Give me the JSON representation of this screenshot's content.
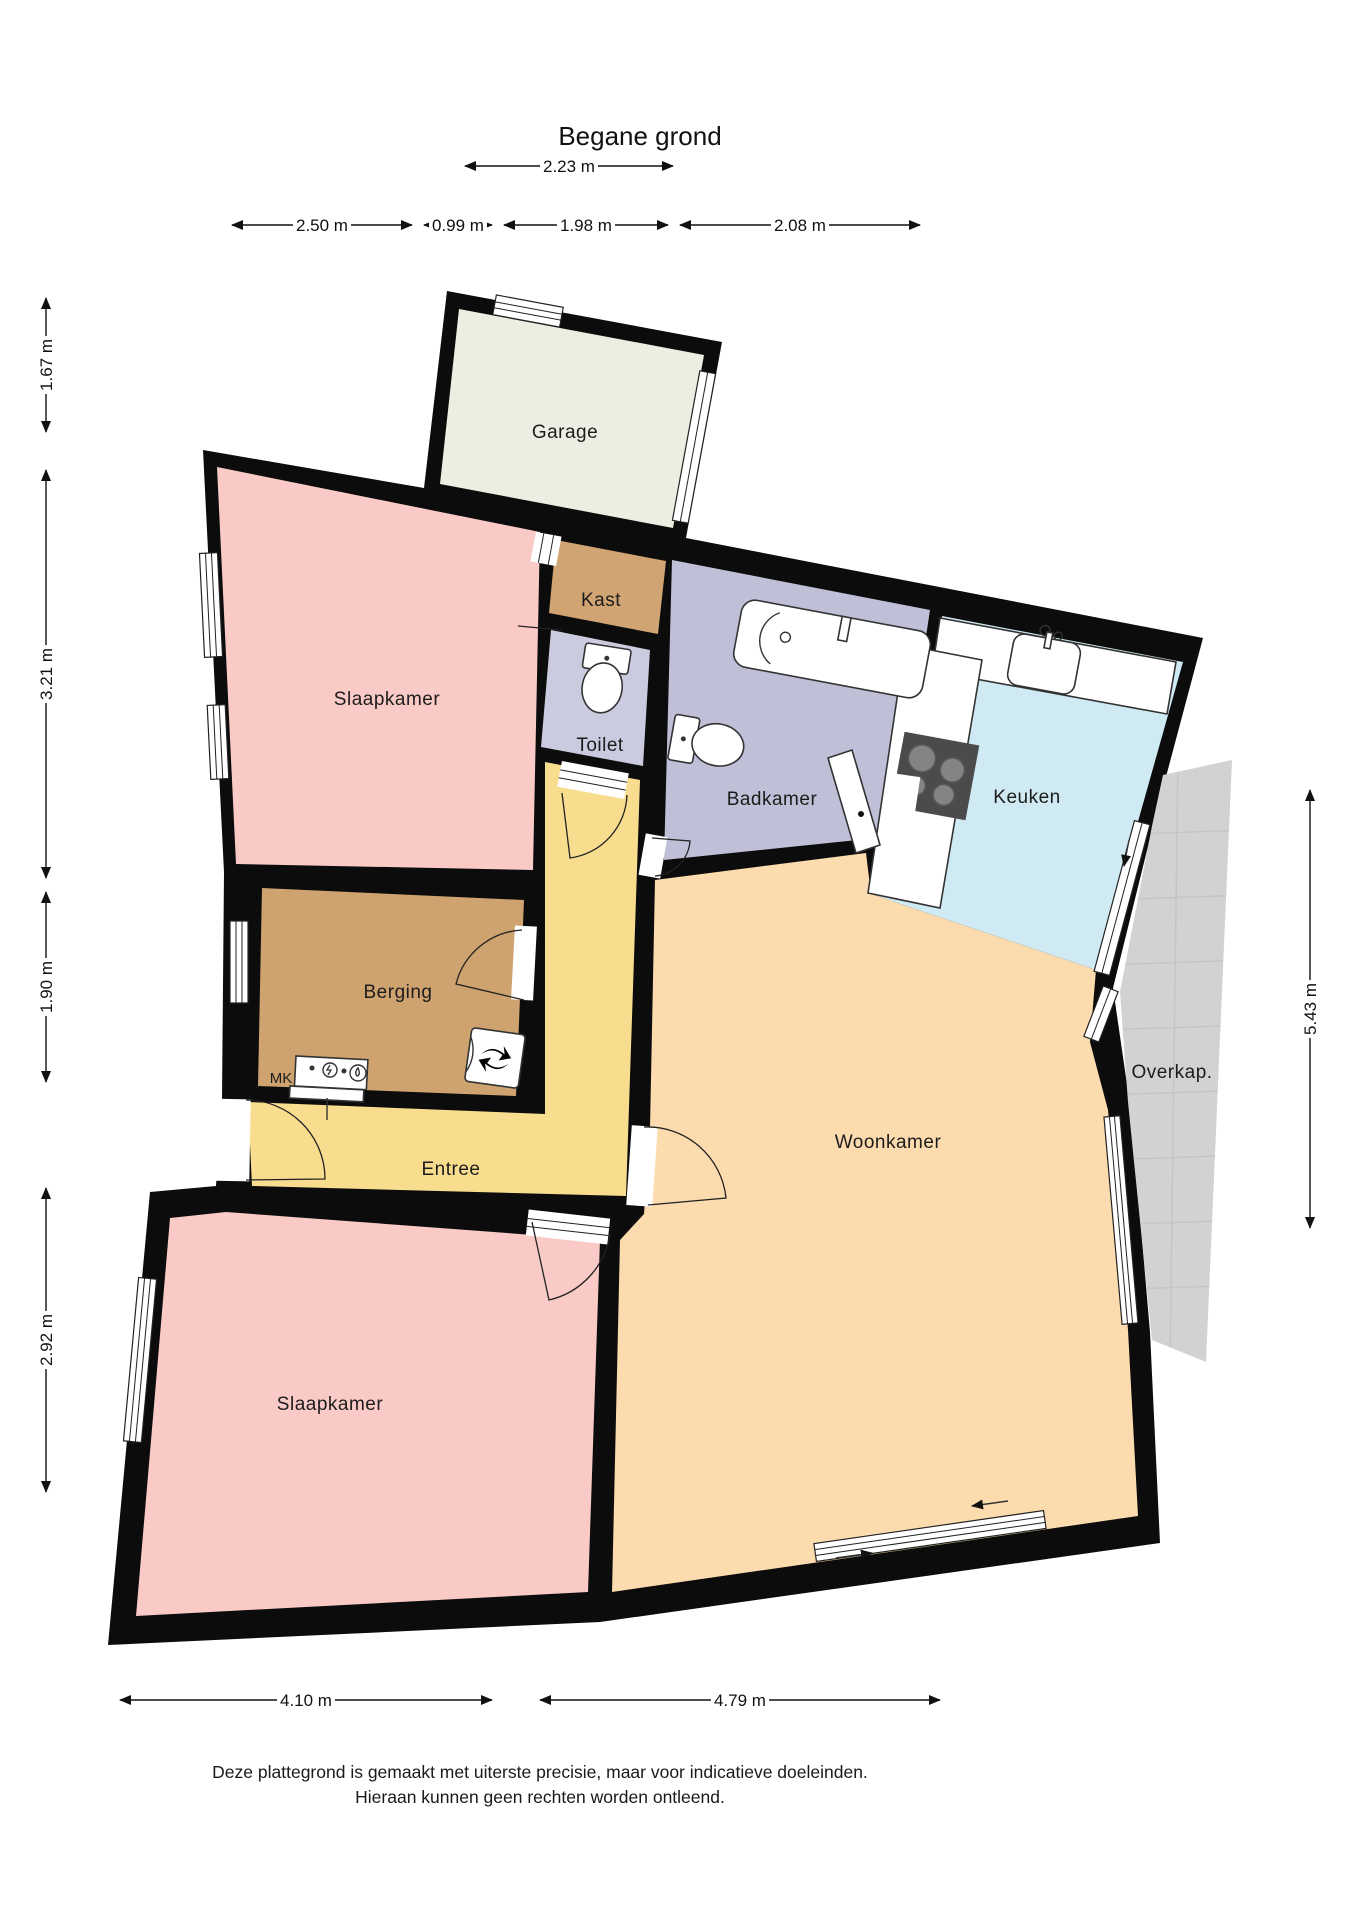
{
  "title": "Begane grond",
  "rooms": {
    "garage": {
      "label": "Garage"
    },
    "kast": {
      "label": "Kast"
    },
    "slaapkamer_boven": {
      "label": "Slaapkamer"
    },
    "toilet": {
      "label": "Toilet"
    },
    "badkamer": {
      "label": "Badkamer"
    },
    "keuken": {
      "label": "Keuken"
    },
    "berging": {
      "label": "Berging"
    },
    "meterkast": {
      "label": "MK"
    },
    "entree": {
      "label": "Entree"
    },
    "woonkamer": {
      "label": "Woonkamer"
    },
    "overkapping": {
      "label": "Overkap."
    },
    "slaapkamer_onder": {
      "label": "Slaapkamer"
    }
  },
  "dimensions": {
    "top_primary": {
      "label": "2.23 m"
    },
    "top_row": [
      {
        "label": "2.50 m"
      },
      {
        "label": "0.99 m"
      },
      {
        "label": "1.98 m"
      },
      {
        "label": "2.08 m"
      }
    ],
    "left": [
      {
        "label": "1.67 m"
      },
      {
        "label": "3.21 m"
      },
      {
        "label": "1.90 m"
      },
      {
        "label": "2.92 m"
      }
    ],
    "right": [
      {
        "label": "5.43 m"
      }
    ],
    "bottom": [
      {
        "label": "4.10 m"
      },
      {
        "label": "4.79 m"
      }
    ]
  },
  "disclaimer": {
    "line1": "Deze plattegrond is gemaakt met uiterste precisie, maar voor indicatieve doeleinden.",
    "line2": "Hieraan kunnen geen rechten worden ontleend."
  },
  "colors": {
    "wall": "#0c0c0c",
    "garage": "#eeede1",
    "slaapkamer": "#f9cac6",
    "kast": "#d0a473",
    "toilet": "#cbcbdf",
    "badkamer": "#bfbfd7",
    "keuken": "#cfeaf2",
    "berging": "#cfa36f",
    "entree": "#f8dd8e",
    "woonkamer": "#fcdcae",
    "overkap": "#d2d2d2",
    "counter": "#ffffff",
    "stove": "#4b4b4b",
    "burner": "#848484"
  }
}
